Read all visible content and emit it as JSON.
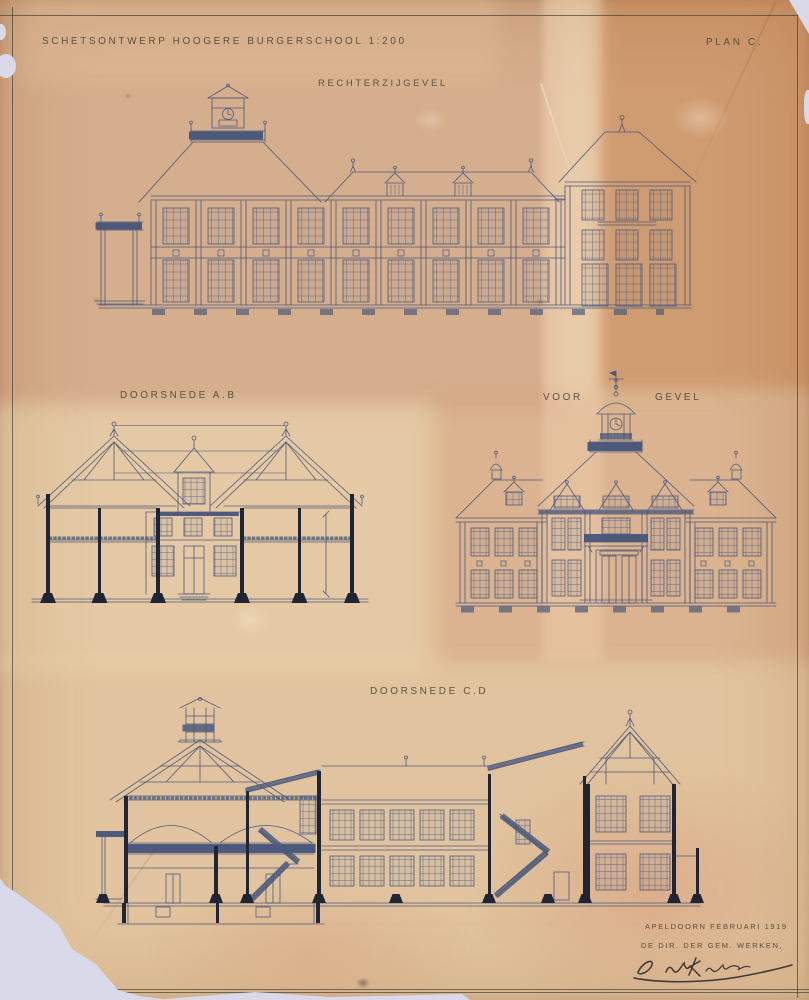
{
  "header": {
    "title": "SCHETSONTWERP HOOGERE BURGERSCHOOL 1:200",
    "plan_label": "PLAN C."
  },
  "views": {
    "right_elevation": {
      "label": "RECHTERZIJGEVEL"
    },
    "section_ab": {
      "label": "DOORSNEDE A.B"
    },
    "front_elevation": {
      "label_left": "VOOR",
      "label_right": "GEVEL"
    },
    "section_cd": {
      "label": "DOORSNEDE C.D"
    }
  },
  "footer": {
    "place_date": "APELDOORN FEBRUARI 1919",
    "authority": "DE DIR. DER GEM. WERKEN,"
  },
  "colors": {
    "paper_base": "#ddbd9a",
    "paper_orange_patch": "#c98e5f",
    "paper_pink_patch": "#dfb49c",
    "paper_cream_patch": "#e6cba6",
    "ink_blue": "#41527a",
    "ink_black": "#10182c",
    "pencil_text": "#4e4837",
    "backdrop": "#d9d9ea"
  }
}
